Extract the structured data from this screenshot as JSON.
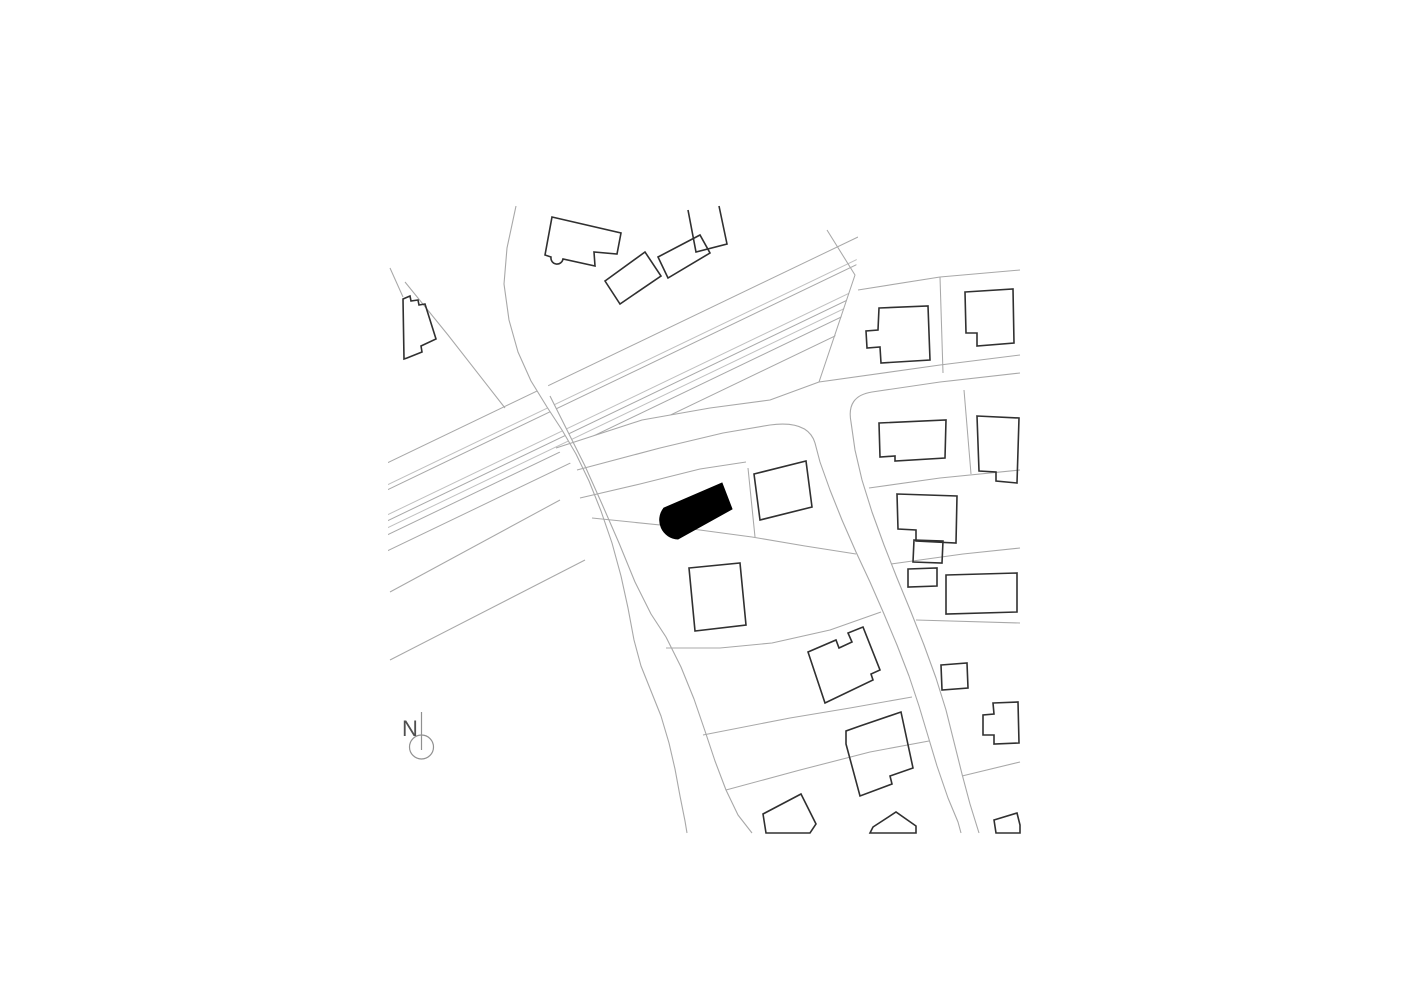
{
  "page": {
    "width": 1415,
    "height": 1000,
    "background": "#ffffff"
  },
  "colors": {
    "parcel_line": "#a8a8a8",
    "rail_inner_line": "#c0c0c0",
    "building_outline": "#303030",
    "highlight_fill": "#000000",
    "road_fill": "#ffffff",
    "north_marker": "#909090",
    "north_text": "#4f4f4f"
  },
  "north": {
    "label": "N",
    "text_x": 402,
    "text_y": 736,
    "font_size": 22,
    "line": {
      "x": 421.5,
      "y1": 712,
      "y2": 750
    },
    "circle": {
      "cx": 421.5,
      "cy": 747,
      "r": 12
    }
  },
  "map": {
    "clip": {
      "x": 388,
      "y": 197,
      "w": 634,
      "h": 637
    },
    "band_clip": [
      [
        380,
        432
      ],
      [
        860,
        203
      ],
      [
        856,
        272
      ],
      [
        816,
        396
      ],
      [
        380,
        648
      ]
    ],
    "band_lines": [
      {
        "x1": 385,
        "y1": 464,
        "x2": 858,
        "y2": 237,
        "light": false
      },
      {
        "x1": 385,
        "y1": 486,
        "x2": 858,
        "y2": 259,
        "light": true
      },
      {
        "x1": 385,
        "y1": 491,
        "x2": 858,
        "y2": 264,
        "light": false
      },
      {
        "x1": 385,
        "y1": 516,
        "x2": 858,
        "y2": 289,
        "light": true
      },
      {
        "x1": 385,
        "y1": 522,
        "x2": 858,
        "y2": 295,
        "light": false
      },
      {
        "x1": 385,
        "y1": 529,
        "x2": 858,
        "y2": 302,
        "light": true
      },
      {
        "x1": 385,
        "y1": 536,
        "x2": 858,
        "y2": 309,
        "light": false
      },
      {
        "x1": 385,
        "y1": 552,
        "x2": 858,
        "y2": 325,
        "light": false
      }
    ],
    "road_fills": [
      "M516,206 L507,248 L504,284 L509,320 L518,352 L531,381 L547,407 L562,430 L576,454 L589,481 L601,511 L612,543 L621,576 L628,608 L634,640 L641,666 L651,691 L661,716 L669,743 L675,769 L680,796 L685,821 L687,833 L752,833 L750,831 L738,815 L726,790 L715,761 L705,731 L694,699 L681,667 L666,637 L651,614 L635,582 L619,543 L602,504 L585,466 L567,430 L550,396 Z",
      "M556,448 L642,420 L710,408 L770,400 L819,382 L940,365 L1020,355 L1020,373 L940,382 L872,392 Q846,396 851,422 L855,450 L862,480 L872,512 L884,545 L897,578 L911,612 L924,645 L936,678 L946,710 L954,742 L962,774 L970,804 L979,833 L961,833 L958,822 L948,798 L937,766 L928,736 L919,706 L909,676 L897,645 L884,614 L870,582 L856,552 L842,520 L830,490 L820,462 Q815,443 808,420 L770,425 L723,433 L660,448 L577,470 Z"
    ],
    "road_edges": [
      "M516,206 L507,248 L504,284 L509,320 L518,352 L531,381 L547,407 L562,430 L576,454 L589,481 L601,511 L612,543 L621,576 L628,608 L634,640 L641,666 L651,691 L661,716 L669,743 L675,769 L680,796 L685,821 L687,833",
      "M550,396 L567,430 L585,466 L602,504 L619,543 L635,582 L651,614 L666,637 L681,667 L694,699 L705,731 L715,761 L726,790 L738,815 L752,833",
      "M556,448 L642,420 L710,408 L770,400 L819,382 L940,365 L1020,355",
      "M1020,373 L940,382 L872,392 Q846,396 851,422 L855,450 L862,480 L872,512 L884,545 L897,578 L911,612 L924,645 L936,678 L946,710 L954,742 L962,774 L970,804 L979,833",
      "M577,470 L660,448 L723,433 L770,425 Q808,420 815,443 L820,462 L830,490 L842,520 L856,552 L870,582 L884,614 L897,645 L909,676 L919,706 L928,736 L937,766 L948,798 L958,822 L961,833"
    ],
    "parcel_lines": [
      "M827,230 L855,275 L819,382",
      "M390,268 L403,297",
      "M405,282 L448,335 L505,408",
      "M560,500 L390,592",
      "M585,560 L390,660",
      "M858,290 L940,277 L1020,270",
      "M940,277 L943,373",
      "M964,390 L971,474",
      "M869,488 L940,478 L1020,470",
      "M891,564 L963,554 L1020,548",
      "M916,620 L1020,623",
      "M962,776 L1020,762",
      "M580,498 L640,484 L700,469 L746,462",
      "M592,518 L670,526 L752,537",
      "M748,468 L755,537",
      "M752,537 L805,546 L856,554",
      "M666,648 L720,648 L772,643 L830,630 L881,612",
      "M703,735 L790,718 L850,708 L912,697",
      "M726,790 L800,770 L870,752 L929,741"
    ],
    "buildings": [
      {
        "name": "building-nw-large",
        "d": "M552,217 L621,233 L617,254 L594,252 L595,266 L563,259 A6,6 0 0 1 551,257 L545,255 Z",
        "closed": true
      },
      {
        "name": "building-nw-rect-1",
        "d": "M605,281 L645,252 L661,276 L620,304 Z",
        "closed": true
      },
      {
        "name": "building-nw-rect-2",
        "d": "M658,257 L700,235 L710,253 L668,278 Z",
        "closed": true
      },
      {
        "name": "building-nw-open",
        "d": "M688,210 L696,252 L727,244 L719,206",
        "closed": false
      },
      {
        "name": "building-west-stepped",
        "d": "M403,299 L410,296 L411,301 L418,300 L419,305 L425,304 L436,339 L421,346 L422,352 L407,358 L404,359 Z",
        "closed": true
      },
      {
        "name": "building-ne-1",
        "d": "M879,308 L928,306 L930,360 L881,363 L880,347 L867,348 L866,331 L878,330 Z",
        "closed": true
      },
      {
        "name": "building-ne-2",
        "d": "M965,292 L1013,289 L1014,343 L977,346 L977,333 L966,333 Z",
        "closed": true
      },
      {
        "name": "building-e-1",
        "d": "M879,423 L946,420 L945,458 L895,461 L895,456 L880,457 Z",
        "closed": true
      },
      {
        "name": "building-e-2",
        "d": "M977,416 L1019,418 L1017,483 L996,481 L996,472 L979,471 Z",
        "closed": true
      },
      {
        "name": "building-e-l-shape",
        "d": "M897,494 L957,496 L956,543 L916,541 L916,530 L898,529 Z",
        "closed": true
      },
      {
        "name": "building-e-l-annex",
        "d": "M914,540 L943,541 L942,563 L913,562 Z",
        "closed": true
      },
      {
        "name": "building-e-small",
        "d": "M908,569 L937,568 L937,586 L908,587 Z",
        "closed": true
      },
      {
        "name": "building-e-wide",
        "d": "M946,575 L1017,573 L1017,612 L946,614 Z",
        "closed": true
      },
      {
        "name": "building-center-square-1",
        "d": "M754,474 L806,461 L812,507 L760,520 Z",
        "closed": true
      },
      {
        "name": "building-center-square-2",
        "d": "M689,568 L740,563 L746,625 L695,631 Z",
        "closed": true
      },
      {
        "name": "building-center-notched-1",
        "d": "M808,652 L836,640 L839,648 L852,642 L848,633 L863,627 L880,670 L871,674 L873,680 L825,703 Z",
        "closed": true
      },
      {
        "name": "building-center-notched-2",
        "d": "M846,744 L846,731 L860,726 L901,712 L913,768 L890,776 L892,784 L860,796 Z",
        "closed": true
      },
      {
        "name": "building-bottom-partial-1",
        "d": "M801,794 L816,824 L810,833 L766,833 L763,814 Z",
        "closed": true
      },
      {
        "name": "building-bottom-partial-2",
        "d": "M873,827 L896,812 L916,826 L916,833 L870,833 Z",
        "closed": true
      },
      {
        "name": "building-bottom-partial-3",
        "d": "M994,820 L1017,813 L1020,825 L1020,833 L996,833 Z",
        "closed": true
      },
      {
        "name": "building-se-bump",
        "d": "M993,703 L1018,702 L1019,743 L994,744 L994,735 L983,735 L983,715 L994,714 Z",
        "closed": true
      },
      {
        "name": "building-se-small",
        "d": "M941,665 L967,663 L968,688 L942,690 Z",
        "closed": true
      }
    ],
    "highlight_building": {
      "name": "site-building-highlight",
      "d": "M722,483 L732,509 L678,539 A19,19 0 0 1 664,508 Z"
    }
  }
}
